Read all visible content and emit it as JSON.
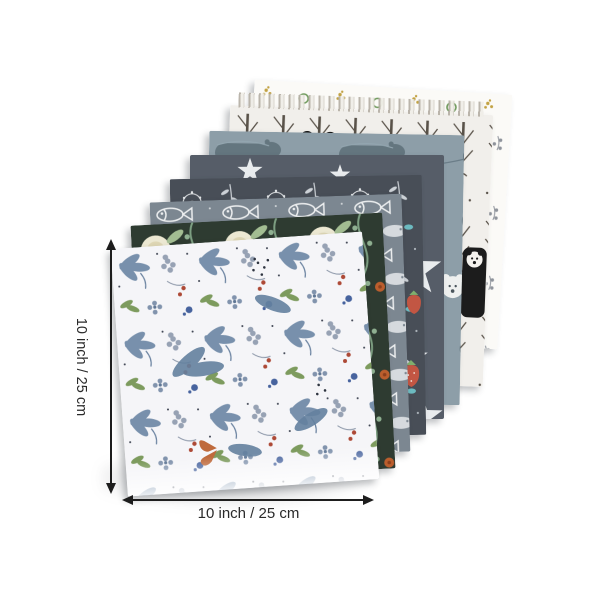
{
  "image_type": "product-photo",
  "product": {
    "name": "patterned fabric squares bundle",
    "layer_count": 8,
    "layers": [
      {
        "name": "botanical-floral-white",
        "position": "front",
        "base_color": "#f5f5f8",
        "accents": [
          "#7890ac",
          "#97a2b4",
          "#ad4936",
          "#7d9b5e",
          "#47639e",
          "#bf6a3c"
        ]
      },
      {
        "name": "peony-vine-dark-green",
        "base_color": "#2e3b31",
        "accents": [
          "#ece8d2",
          "#a3bd92",
          "#bb5e2d"
        ]
      },
      {
        "name": "fish-gray",
        "base_color": "#7c8791",
        "accents": [
          "#eceeef"
        ]
      },
      {
        "name": "wildflower-dark-slate",
        "base_color": "#484e57",
        "accents": [
          "#e2e5e7",
          "#d9a3bd",
          "#6cbac0",
          "#c25643"
        ]
      },
      {
        "name": "stars-charcoal",
        "base_color": "#565d68",
        "accents": [
          "#e9ecee"
        ]
      },
      {
        "name": "animals-blue-gray",
        "base_color": "#8d9ea8",
        "accents": [
          "#64767f",
          "#e8ecee"
        ]
      },
      {
        "name": "forest-panda-white",
        "base_color": "#f1efeb",
        "accents": [
          "#57504a",
          "#161616"
        ],
        "detail": "fringed top edge"
      },
      {
        "name": "tiny-motifs-white",
        "position": "back",
        "base_color": "#fbfaf7",
        "accents": [
          "#c2a243",
          "#6f9a5c",
          "#a8453c",
          "#5b77ad"
        ]
      }
    ]
  },
  "dimensions": {
    "vertical_label": "10 inch / 25 cm",
    "horizontal_label": "10 inch / 25 cm",
    "arrow_color": "#1d1d1d",
    "label_color": "#2a2a2a"
  }
}
